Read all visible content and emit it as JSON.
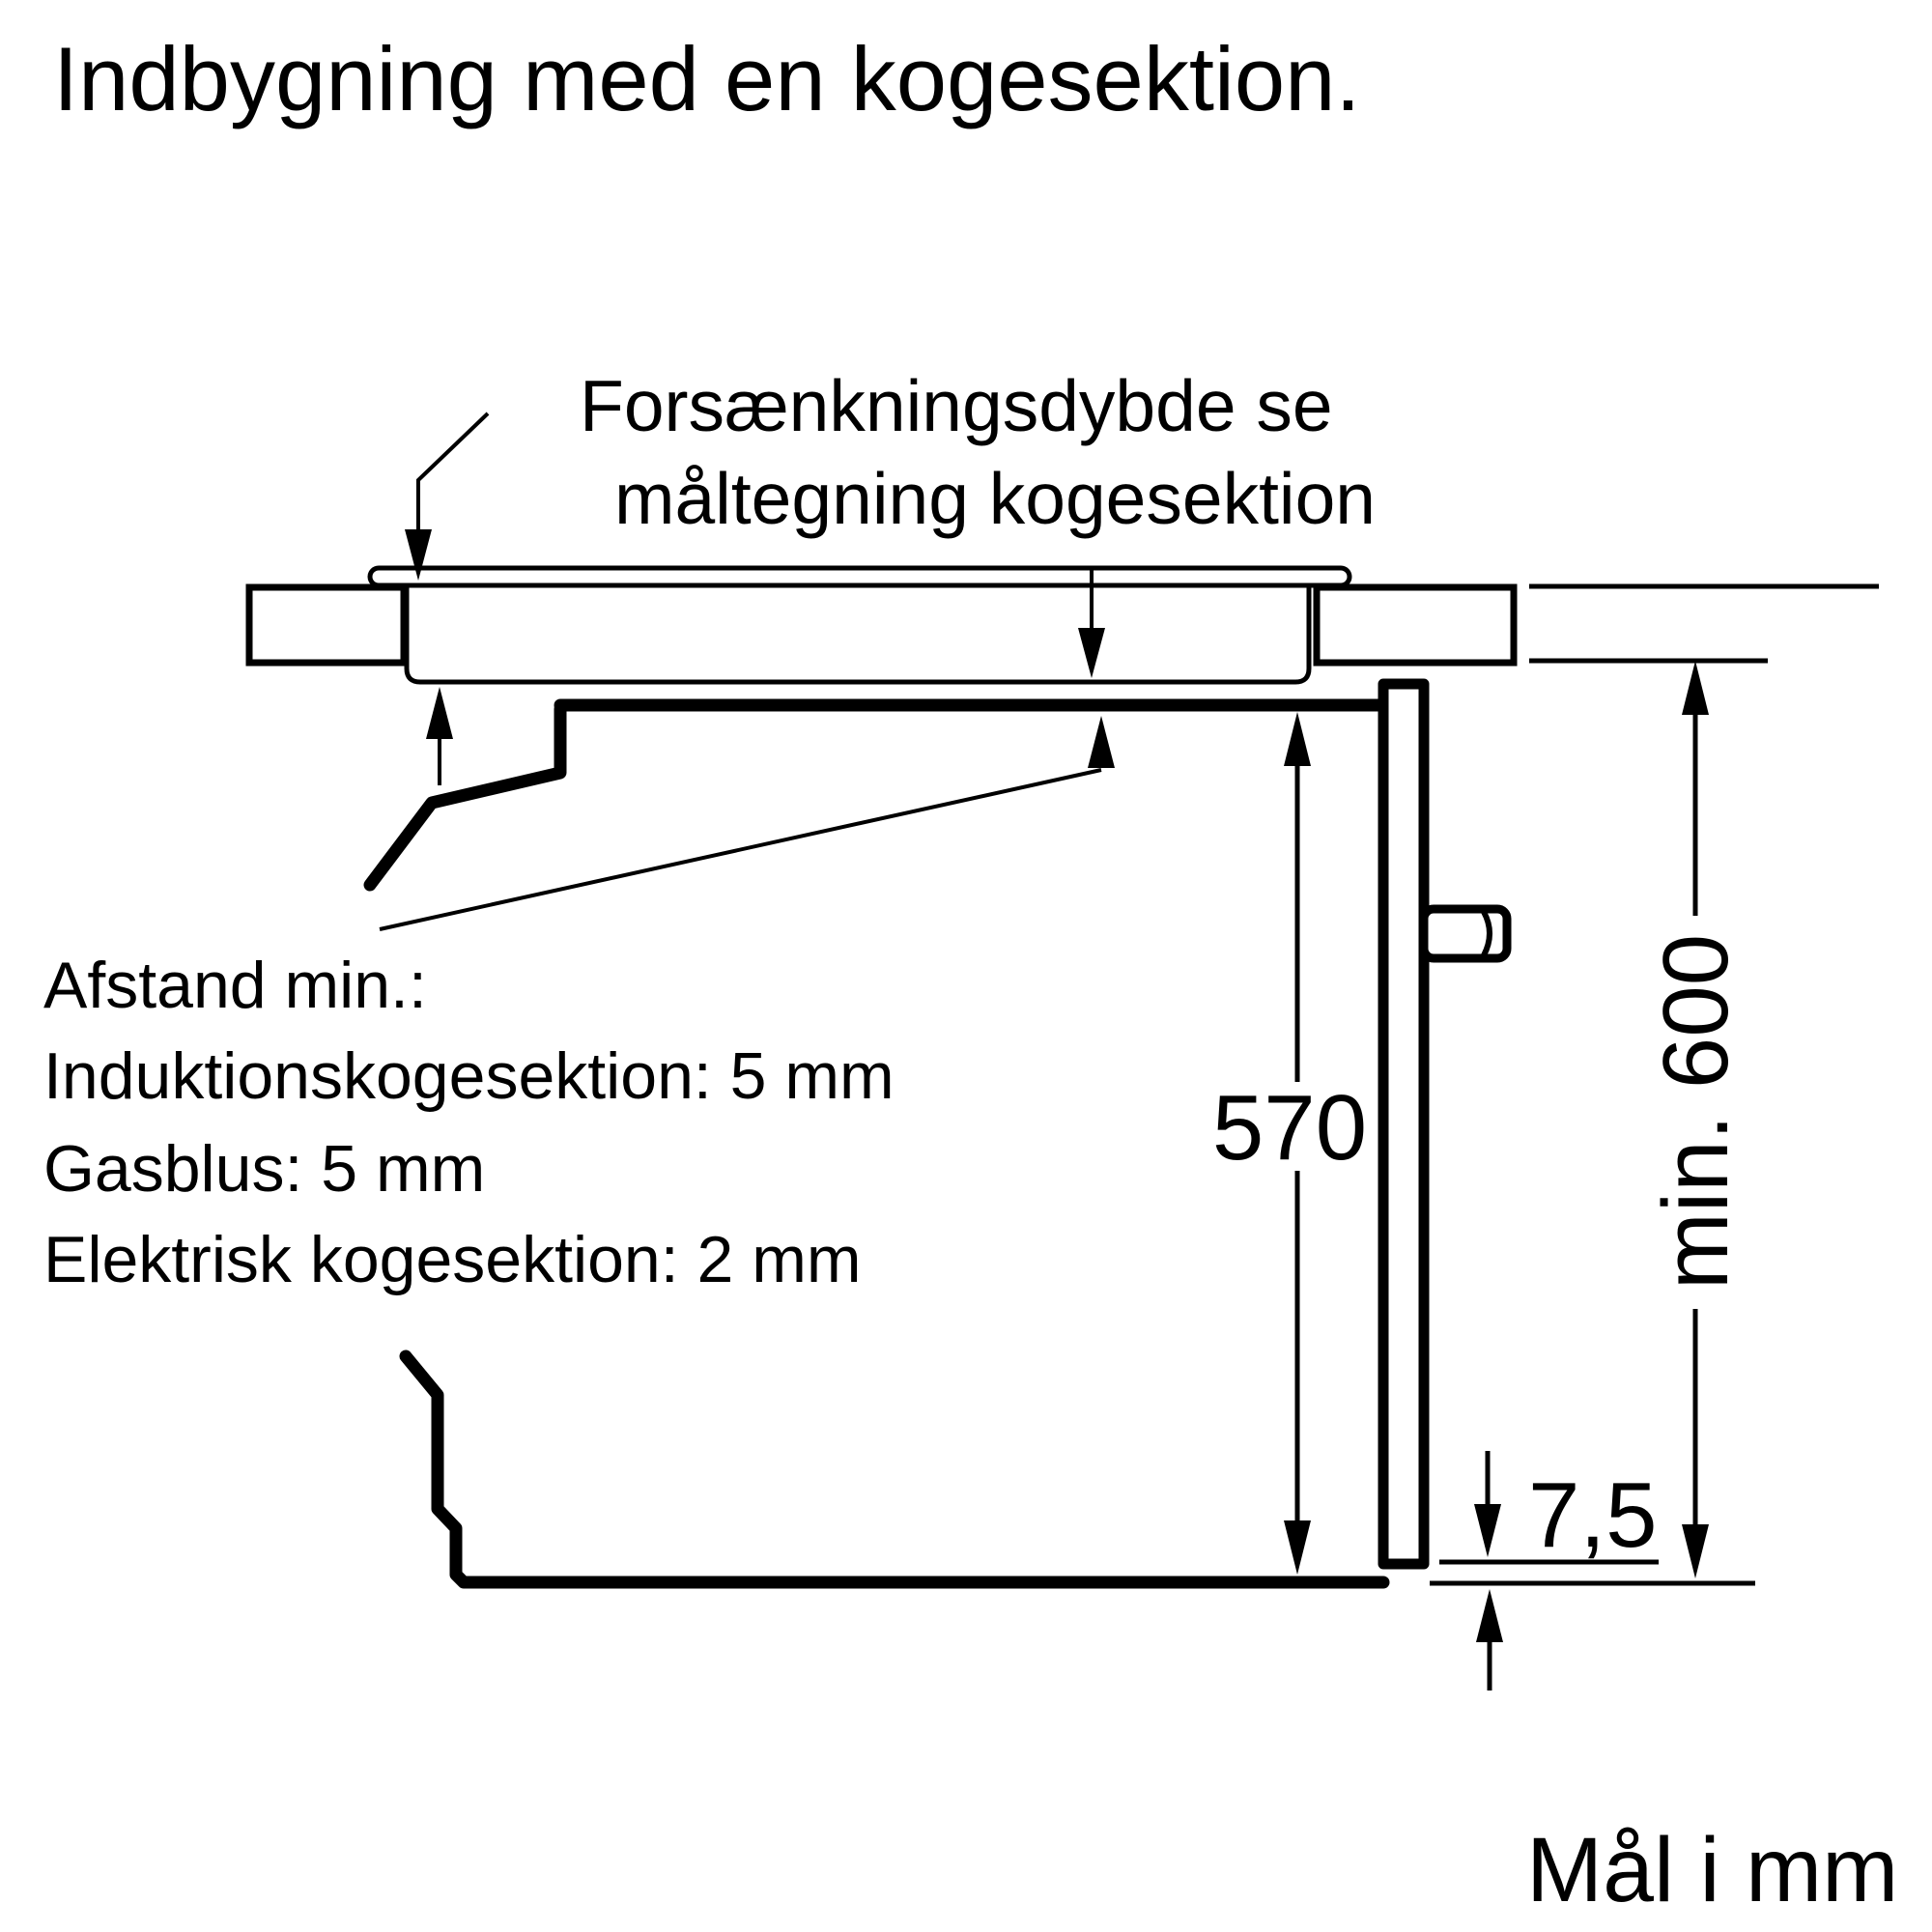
{
  "colors": {
    "ink": "#000000",
    "background": "#ffffff"
  },
  "title": "Indbygning med en kogesektion.",
  "recess_note": {
    "line1": "Forsænkningsdybde se",
    "line2": "måltegning kogesektion"
  },
  "clearance_note": {
    "line1": "Afstand min.:",
    "line2": "Induktionskogesektion: 5 mm",
    "line3": "Gasblus: 5 mm",
    "line4": "Elektrisk kogesektion: 2 mm"
  },
  "dimensions": {
    "oven_front_height": "570",
    "worktop_to_bottom_min": "min. 600",
    "front_frame_offset": "7,5"
  },
  "footer": {
    "units_note": "Mål i mm"
  }
}
